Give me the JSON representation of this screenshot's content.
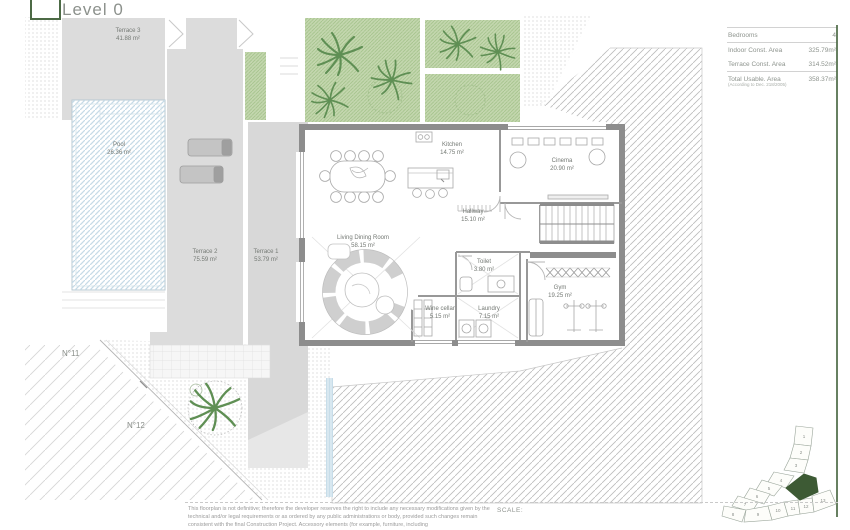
{
  "header": {
    "title": "Level 0"
  },
  "info_panel": {
    "rows": [
      {
        "label": "Bedrooms",
        "value": "4"
      },
      {
        "label": "Indoor Const. Area",
        "value": "325.79m²"
      },
      {
        "label": "Terrace Const. Area",
        "value": "314.52m²"
      },
      {
        "label": "Total Usable. Area",
        "value": "358.37m²"
      }
    ],
    "note": "(According to Dec. 218/2005)"
  },
  "rooms": [
    {
      "name": "Kitchen",
      "area": "14.75 m²"
    },
    {
      "name": "Cinema",
      "area": "20.90 m²"
    },
    {
      "name": "Hallway",
      "area": "15.10 m²"
    },
    {
      "name": "Living Dining Room",
      "area": "58.15 m²"
    },
    {
      "name": "Toilet",
      "area": "3.80 m²"
    },
    {
      "name": "Wine cellar",
      "area": "5.15 m²"
    },
    {
      "name": "Laundry",
      "area": "7.15 m²"
    },
    {
      "name": "Gym",
      "area": "19.25 m²"
    }
  ],
  "outdoor_areas": [
    {
      "name": "Terrace 3",
      "area": "41.88 m²"
    },
    {
      "name": "Pool",
      "area": "26.36 m²"
    },
    {
      "name": "Terrace 2",
      "area": "75.59 m²"
    },
    {
      "name": "Terrace 1",
      "area": "53.79 m²"
    }
  ],
  "plot_labels": {
    "left": "N°11",
    "bottom": "N°12"
  },
  "site_plan": {
    "plots": [
      "1",
      "2",
      "3",
      "4",
      "5",
      "6",
      "7",
      "8",
      "9",
      "10",
      "11",
      "12",
      "13"
    ],
    "highlight_color": "#3d5a34"
  },
  "footer": {
    "disclaimer_lines": [
      "This floorplan is not definitive; therefore the developer reserves the right to include any necessary modifications given by the",
      "technical and/or legal requirements or as ordered by any public administrations or body, provided such changes remain",
      "consistent with the final Construction Project. Accessory elements (for example, furniture, including"
    ],
    "scale_label": "SCALE:"
  },
  "colors": {
    "accent_green": "#4c6a45",
    "garden_green": "#c3d6ae",
    "terrace_gray": "#dcdcdc",
    "wall_gray": "#8d8d8d",
    "pool_blue": "#c6dbe7",
    "site_highlight": "#3d5a34"
  }
}
